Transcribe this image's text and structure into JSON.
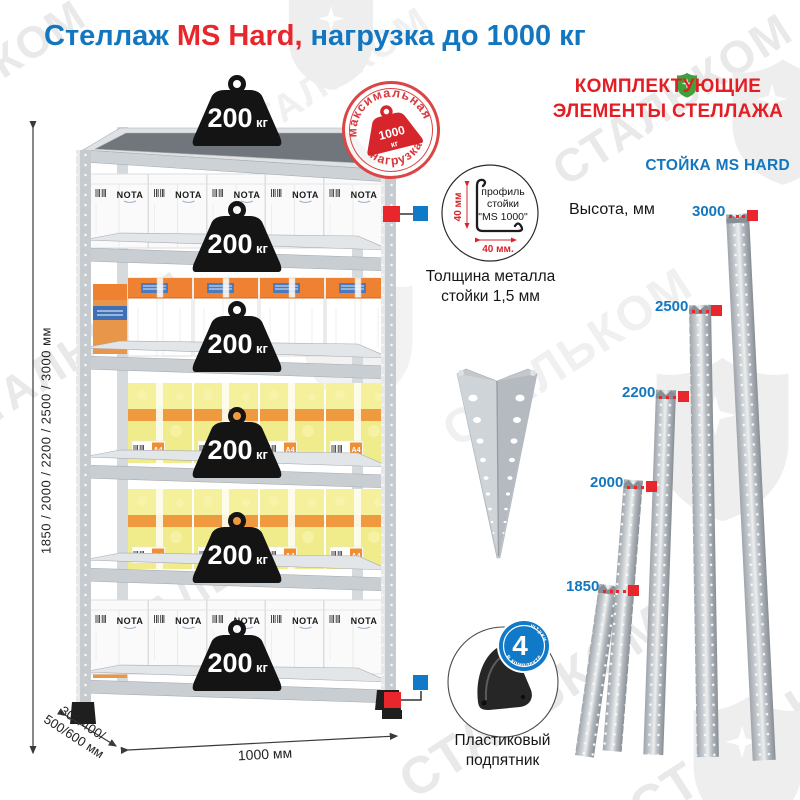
{
  "title": {
    "product": "Стеллаж",
    "model": "MS Hard,",
    "suffix": "нагрузка до 1000 кг"
  },
  "watermark": {
    "brand": "СТАЛЬКОМ"
  },
  "stamp": {
    "arc_top": "максимальная",
    "arc_bottom": "нагрузка",
    "value": "1000",
    "unit": "кг"
  },
  "shelf_weight": {
    "value": "200",
    "unit": "кг"
  },
  "boxes": {
    "brand": "NOTA",
    "paper": "A4"
  },
  "dimensions": {
    "height": "1850 / 2000 / 2200 / 2500 / 3000 мм",
    "depth_line1": "300/400/",
    "depth_line2": "500/600 мм",
    "width": "1000 мм"
  },
  "profile": {
    "label_line1": "профиль",
    "label_line2": "стойки",
    "label_line3": "\"MS 1000\"",
    "dim_vertical": "40 мм",
    "dim_horizontal": "40 мм.",
    "thickness_line1": "Толщина металла",
    "thickness_line2": "стойки 1,5 мм"
  },
  "foot": {
    "badge_value": "4",
    "badge_word": "штуки",
    "badge_arc": "в комплекте",
    "label_line1": "Пластиковый",
    "label_line2": "подпятник"
  },
  "components": {
    "header_line1": "КОМПЛЕКТУЮЩИЕ",
    "header_line2": "ЭЛЕМЕНТЫ СТЕЛЛАЖА",
    "stand_title": "СТОЙКА MS HARD",
    "height_label": "Высота, мм",
    "heights": [
      "3000",
      "2500",
      "2200",
      "2000",
      "1850"
    ]
  },
  "colors": {
    "blue": "#1377bf",
    "red": "#e8262b",
    "stamp_red": "#d8393f",
    "badge_blue": "#1079c8",
    "metal_gray": "#c9ced3",
    "weight_black": "#141414",
    "box_yellow": "#f1ec8b",
    "box_orange": "#ee8232",
    "watermark_gray": "#e9e9e9",
    "logo_green": "#3fa03c"
  }
}
